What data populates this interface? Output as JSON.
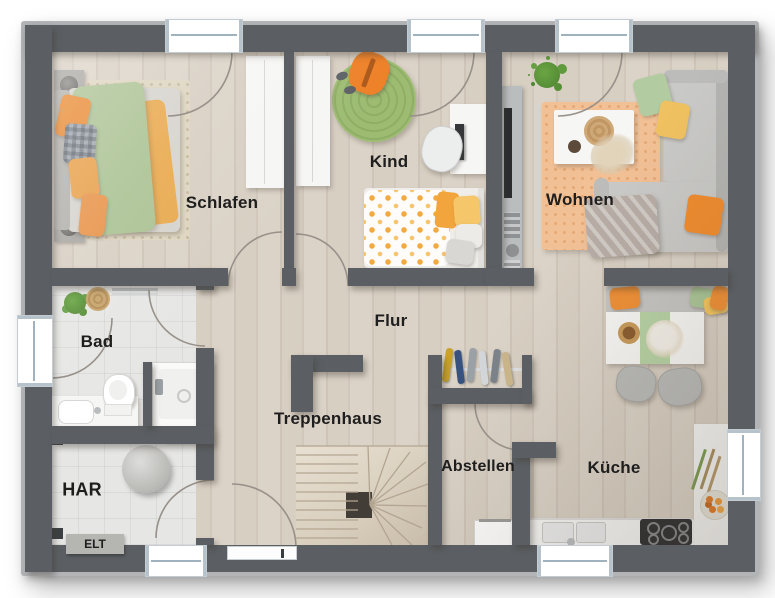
{
  "rooms": {
    "schlafen": "Schlafen",
    "kind": "Kind",
    "wohnen": "Wohnen",
    "bad": "Bad",
    "flur": "Flur",
    "treppenhaus": "Treppenhaus",
    "har": "HAR",
    "elt": "ELT",
    "abstellen": "Abstellen",
    "kueche": "Küche"
  },
  "colors": {
    "wall": "#5b5f63",
    "wood_floor": "#d6cdc1",
    "tile_floor": "#e6e6e4",
    "rug_green": "#9dbc72",
    "rug_peach": "#f2c095",
    "rug_beige": "#ded5c0",
    "accent_orange": "#ee8a2d",
    "accent_green": "#aac494",
    "accent_yellow": "#f0c160",
    "furniture_white": "#f6f6f4",
    "sofa_gray": "#c9c9c7"
  }
}
